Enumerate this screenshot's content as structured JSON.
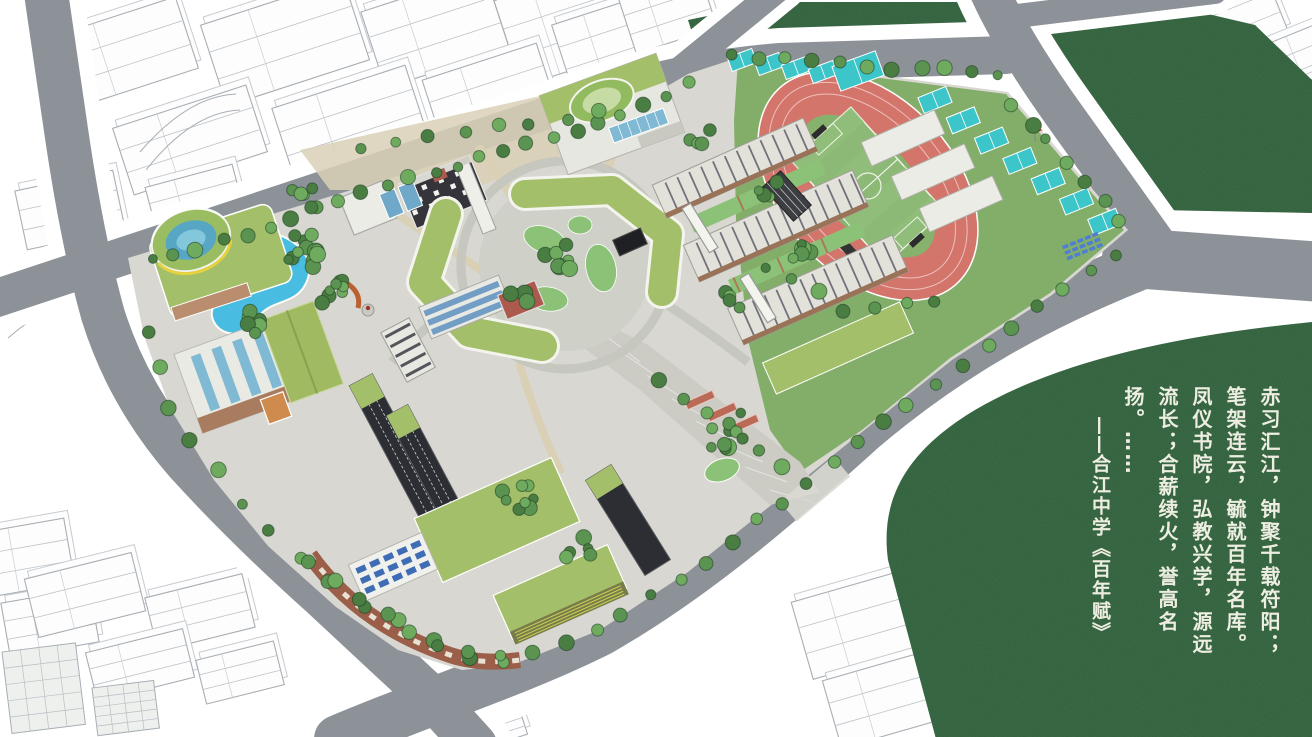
{
  "poem": {
    "line1": "赤习汇江，钟聚千载符阳；",
    "line2": "笔架连云，毓就百年名库。",
    "line3": "凤仪书院，弘教兴学，源远",
    "line4": "流长；合薪续火，誉高名",
    "line5": "扬。",
    "ellipsis": "……",
    "attribution_dash": "——",
    "attribution": "合江中学《百年赋》"
  },
  "colors": {
    "field_green": "#3e6e4a",
    "road_gray": "#8d9298",
    "sidewalk": "#ffffff",
    "ground": "#d8d7d1",
    "path_tan": "#d9d0b6",
    "plaza_gray": "#cfd0c8",
    "lawn_green": "#83ae6a",
    "courtyard_green": "#8cc178",
    "track_red": "#d4756c",
    "pitch_green": "#8cb976",
    "court_cyan": "#3cc6ca",
    "pond_blue": "#49bce1",
    "roof_olive": "#a4bf6a",
    "roof_olive_dark": "#9fba60",
    "tree_dark": "#4a7d42",
    "tree_mid": "#5b9350",
    "tree_light": "#6fab5e",
    "wire_stroke": "#a8aeb4",
    "brick": "#9b5f49",
    "dark_bldg": "#2c2e33",
    "glass_blue": "#7fb9d4",
    "panel_blue": "#3f6db5",
    "accent_red": "#ad5a4e",
    "accent_yellow": "#e6d23e",
    "poem_ink": "#edeee1"
  }
}
